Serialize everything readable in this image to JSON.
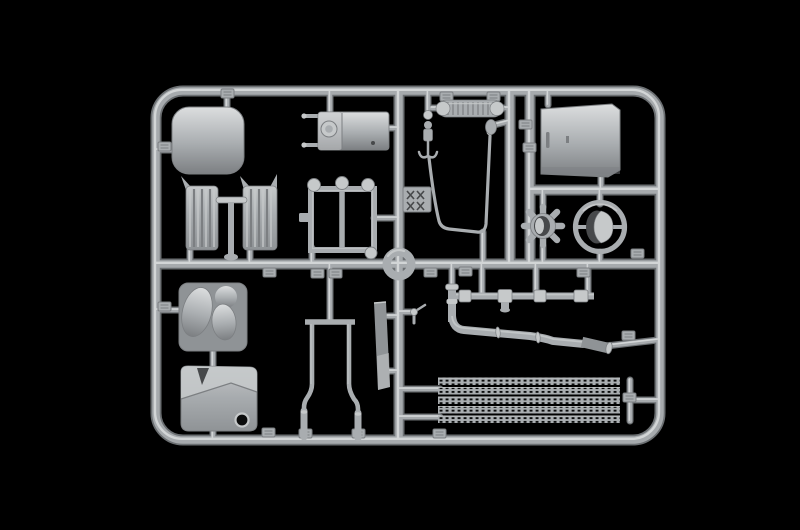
{
  "scene": {
    "type": "photograph",
    "subject": "injection-moulded model kit sprue (plastic parts tree) in light grey styrene, photographed on a black background",
    "orientation": "landscape rectangular sprue frame with internal runners and attached truck-model parts"
  },
  "colors": {
    "background": "#000000",
    "runner_dark": "#6b6f72",
    "runner_mid": "#a6aaad",
    "runner_hi": "#d2d5d6",
    "part": "#a9adb0",
    "part_light": "#c6c9ca",
    "part_lighter": "#dcdedf",
    "part_mid": "#8f9396",
    "part_shadow": "#7c7f82",
    "part_dark": "#47494b",
    "hole": "#0b0c0c"
  },
  "parts": [
    {
      "id": "roof-panel",
      "label": "rounded cab roof panel"
    },
    {
      "id": "air-tank-left",
      "label": "ribbed air tank (left)"
    },
    {
      "id": "air-tank-right",
      "label": "ribbed air tank (right)"
    },
    {
      "id": "tank-stand",
      "label": "T-shaped tank stand"
    },
    {
      "id": "battery-box",
      "label": "battery box with filler cap"
    },
    {
      "id": "ladder-frame-part",
      "label": "rectangular ladder frame with round knobs"
    },
    {
      "id": "center-ring",
      "label": "circular ring junction at sprue centre"
    },
    {
      "id": "intercooler-core",
      "label": "ribbed cylinder core"
    },
    {
      "id": "shock-chain-part",
      "label": "small stacked-cylinder part with hook"
    },
    {
      "id": "grab-handle-loop",
      "label": "long thin trapezoid grab-handle rod"
    },
    {
      "id": "mirror-part",
      "label": "small oval mirror"
    },
    {
      "id": "door-panel",
      "label": "large flat door panel with handle recess"
    },
    {
      "id": "wheel-hub-part",
      "label": "toothed wheel hub"
    },
    {
      "id": "steering-wheel",
      "label": "steering wheel with D-shaped hub"
    },
    {
      "id": "seat-cushion-part",
      "label": "moulded seat cushion on base plate"
    },
    {
      "id": "engine-cover-part",
      "label": "boxy engine cover with notch and hole"
    },
    {
      "id": "chassis-rails",
      "label": "two long bent chassis rails on crossbar"
    },
    {
      "id": "flat-plate-part",
      "label": "narrow flat plate"
    },
    {
      "id": "valve-part",
      "label": "small valve with handle"
    },
    {
      "id": "pipe-fittings-row",
      "label": "horizontal pipe run with collar fittings"
    },
    {
      "id": "exhaust-stack",
      "label": "short vertical exhaust stack"
    },
    {
      "id": "exhaust-pipe",
      "label": "long bent exhaust pipe"
    },
    {
      "id": "tread-plates",
      "label": "five perforated tread strips"
    },
    {
      "id": "sprue-id-tag",
      "label": "moulded identification tag with cross hatching"
    }
  ]
}
